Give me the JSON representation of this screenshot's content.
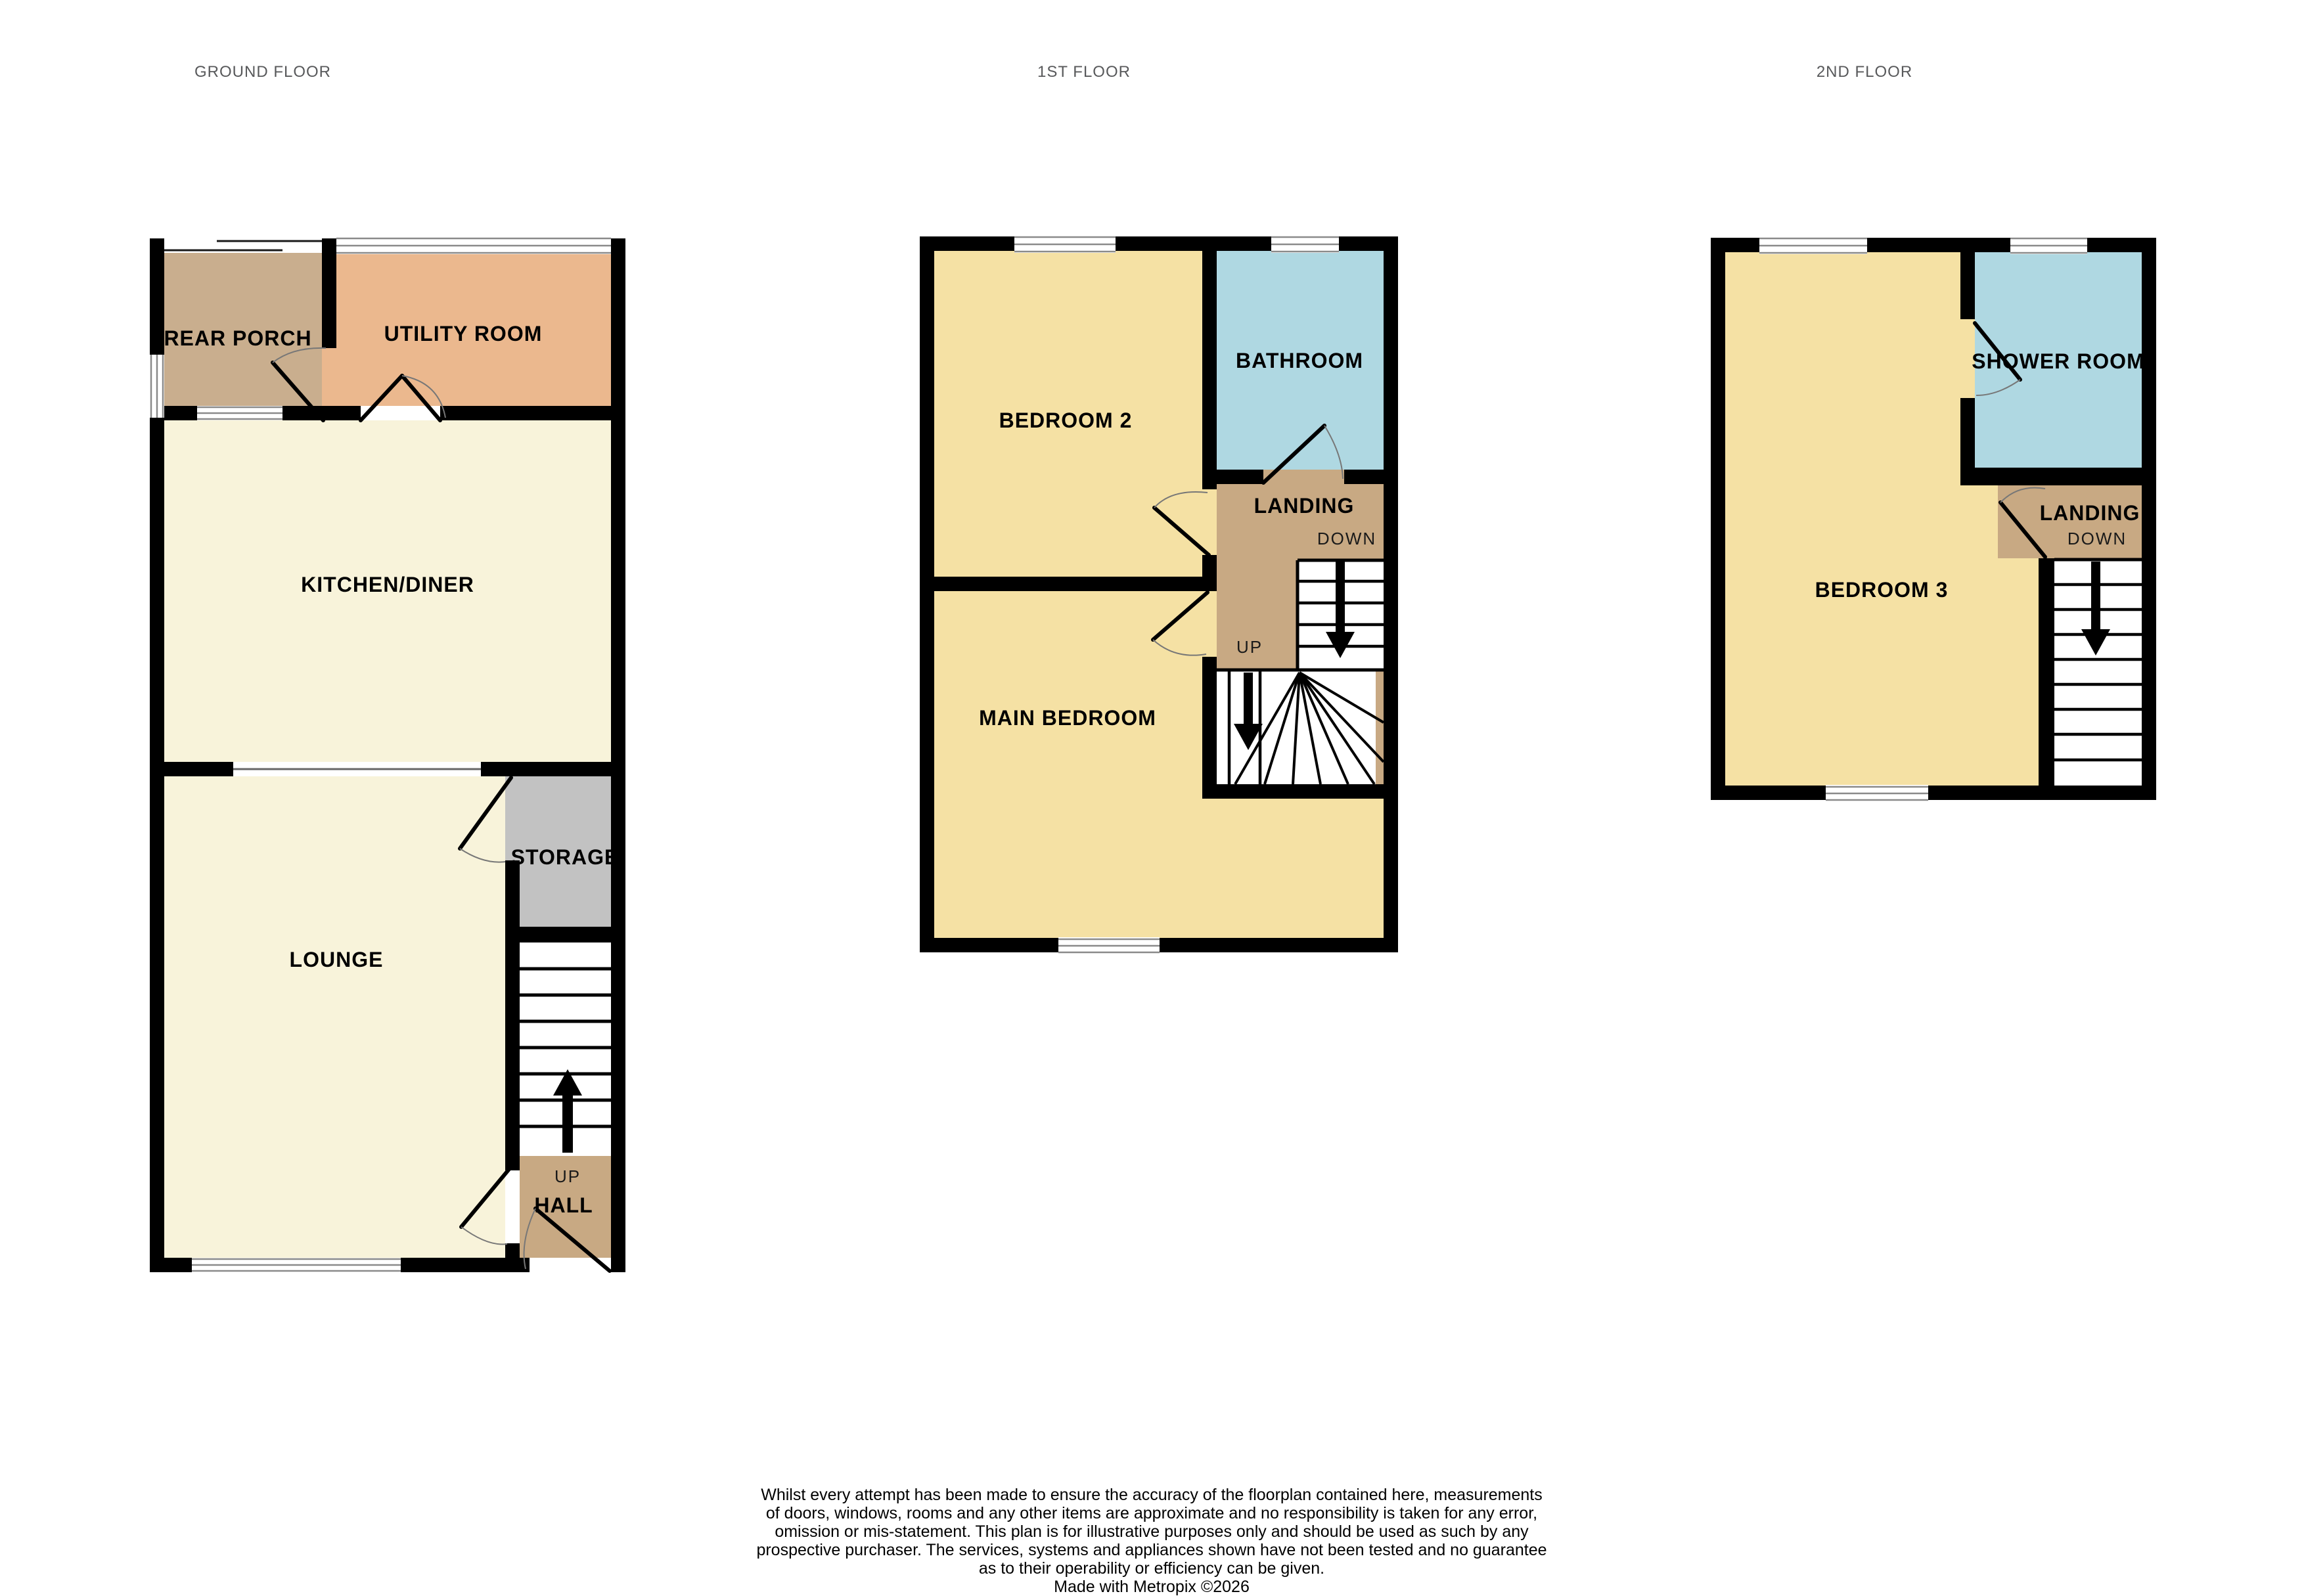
{
  "floors": [
    {
      "id": "ground",
      "title": "GROUND FLOOR",
      "labels": {
        "rear_porch": "REAR PORCH",
        "utility": "UTILITY ROOM",
        "kitchen": "KITCHEN/DINER",
        "lounge": "LOUNGE",
        "storage": "STORAGE",
        "hall": "HALL",
        "up": "UP"
      }
    },
    {
      "id": "first",
      "title": "1ST FLOOR",
      "labels": {
        "bedroom2": "BEDROOM 2",
        "bathroom": "BATHROOM",
        "landing": "LANDING",
        "down": "DOWN",
        "up": "UP",
        "main_bedroom": "MAIN BEDROOM"
      }
    },
    {
      "id": "second",
      "title": "2ND FLOOR",
      "labels": {
        "bedroom3": "BEDROOM 3",
        "shower": "SHOWER ROOM",
        "landing": "LANDING",
        "down": "DOWN"
      }
    }
  ],
  "colors": {
    "cream": "#F8F3DA",
    "yellow": "#F5E1A4",
    "blue": "#AFD8E2",
    "salmon": "#EBB88E",
    "porch_tan": "#C9AE8E",
    "hall_tan": "#C8A983",
    "storage_grey": "#C2C2C2",
    "wall": "#000000",
    "title_grey": "#58595B"
  },
  "disclaimer": {
    "lines": [
      "Whilst every attempt has been made to ensure the accuracy of the floorplan contained here, measurements",
      "of doors, windows, rooms and any other items are approximate and no responsibility is taken for any error,",
      "omission or mis-statement. This plan is for illustrative purposes only and should be used as such by any",
      "prospective purchaser. The services, systems and appliances shown have not been tested and no guarantee",
      "as to their operability or efficiency can be given."
    ],
    "credit": "Made with Metropix ©2026"
  }
}
